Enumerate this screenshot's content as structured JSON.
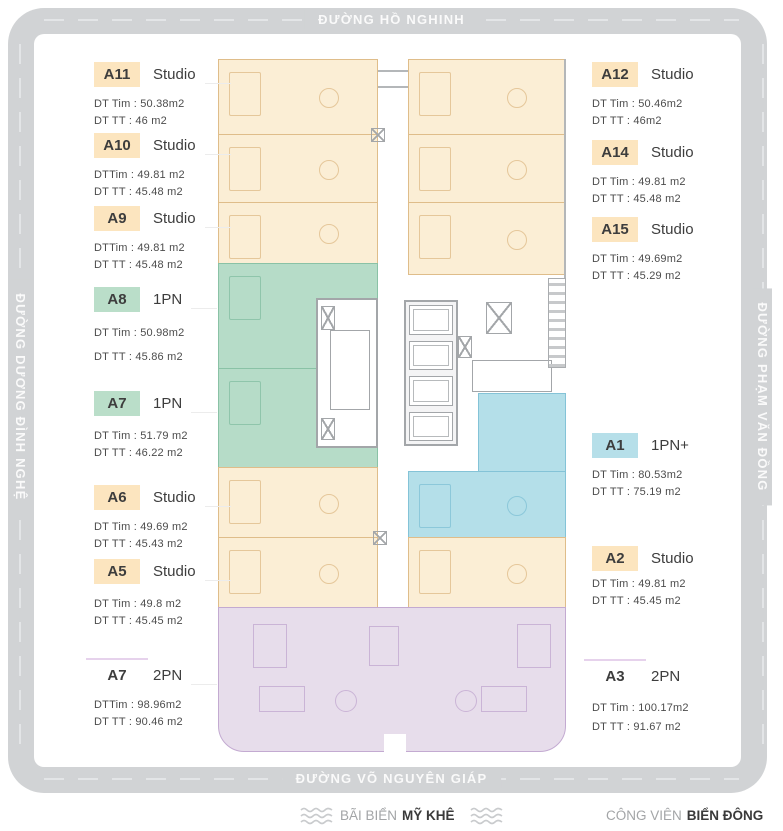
{
  "streets": {
    "top": "ĐƯỜNG HỒ NGHINH",
    "left": "ĐƯỜNG DƯƠNG ĐÌNH NGHỆ",
    "right": "ĐƯỜNG PHẠM VĂN ĐỒNG",
    "bottom": "ĐƯỜNG VÕ NGUYÊN GIÁP"
  },
  "legend": {
    "beach_prefix": "BÃI BIỂN",
    "beach_name": "MỸ KHÊ",
    "park_prefix": "CÔNG VIÊN",
    "park_name": "BIỂN ĐÔNG"
  },
  "colors": {
    "road": "#d1d3d5",
    "studio_fill": "#fbeed5",
    "one_bedroom_fill": "#b6dcc8",
    "one_bedroom_plus_fill": "#b4dfe9",
    "two_bedroom_fill": "#e7ddeb",
    "badge_studio": "#fce5bf",
    "badge_1pn": "#badec9",
    "badge_1pn_plus": "#b6dfe9",
    "badge_2pn": "#eaddef"
  },
  "units_left": [
    {
      "id": "A11",
      "type": "Studio",
      "area1": "DT Tim : 50.38m2",
      "area2": "DT TT : 46 m2"
    },
    {
      "id": "A10",
      "type": "Studio",
      "area1": "DTTim : 49.81 m2",
      "area2": "DT TT : 45.48 m2"
    },
    {
      "id": "A9",
      "type": "Studio",
      "area1": "DTTim : 49.81 m2",
      "area2": "DT TT : 45.48 m2"
    },
    {
      "id": "A8",
      "type": "1PN",
      "area1": "DT Tim : 50.98m2",
      "area2": "DT TT : 45.86 m2"
    },
    {
      "id": "A7",
      "type": "1PN",
      "area1": "DT Tim : 51.79 m2",
      "area2": "DT TT : 46.22 m2"
    },
    {
      "id": "A6",
      "type": "Studio",
      "area1": "DT Tim : 49.69 m2",
      "area2": "DT TT : 45.43 m2"
    },
    {
      "id": "A5",
      "type": "Studio",
      "area1": "DT Tim : 49.8 m2",
      "area2": "DT TT : 45.45 m2"
    },
    {
      "id": "A7",
      "type": "2PN",
      "area1": "DTTim : 98.96m2",
      "area2": "DT TT : 90.46 m2"
    }
  ],
  "units_right": [
    {
      "id": "A12",
      "type": "Studio",
      "area1": "DT Tim : 50.46m2",
      "area2": "DT TT : 46m2"
    },
    {
      "id": "A14",
      "type": "Studio",
      "area1": "DT Tim : 49.81 m2",
      "area2": "DT TT : 45.48 m2"
    },
    {
      "id": "A15",
      "type": "Studio",
      "area1": "DT Tim : 49.69m2",
      "area2": "DT TT : 45.29 m2"
    },
    {
      "id": "A1",
      "type": "1PN+",
      "area1": "DT Tim : 80.53m2",
      "area2": "DT TT : 75.19 m2"
    },
    {
      "id": "A2",
      "type": "Studio",
      "area1": "DT Tim : 49.81 m2",
      "area2": "DT TT : 45.45 m2"
    },
    {
      "id": "A3",
      "type": "2PN",
      "area1": "DT Tim : 100.17m2",
      "area2": "DT TT : 91.67 m2"
    }
  ]
}
